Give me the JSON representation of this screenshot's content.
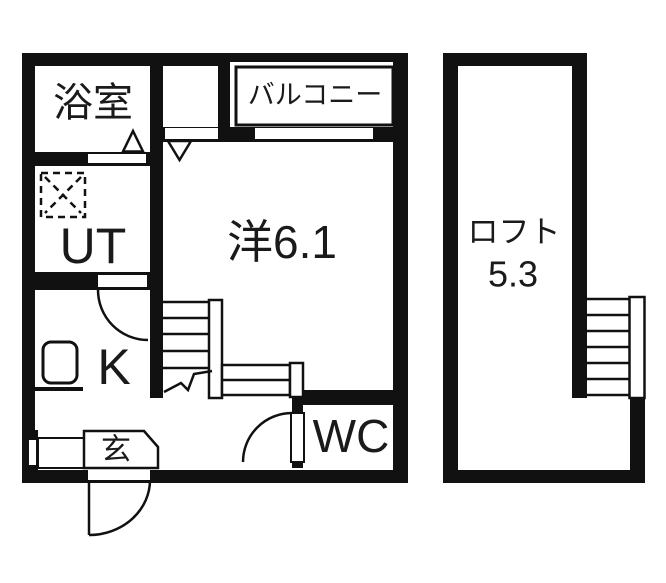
{
  "document": {
    "type": "japanese-apartment-floorplan",
    "floors": [
      "1F",
      "loft"
    ]
  },
  "colors": {
    "wall": "#111111",
    "text": "#1a1a1a",
    "background": "#ffffff"
  },
  "rooms": {
    "bathroom": {
      "label": "浴室"
    },
    "balcony": {
      "label": "バルコニー"
    },
    "utility": {
      "label": "UT"
    },
    "western_room": {
      "label": "洋6.1"
    },
    "kitchen": {
      "label": "K"
    },
    "entrance": {
      "label": "玄"
    },
    "toilet": {
      "label": "WC"
    },
    "loft": {
      "label": "ロフト",
      "size": "5.3"
    }
  }
}
